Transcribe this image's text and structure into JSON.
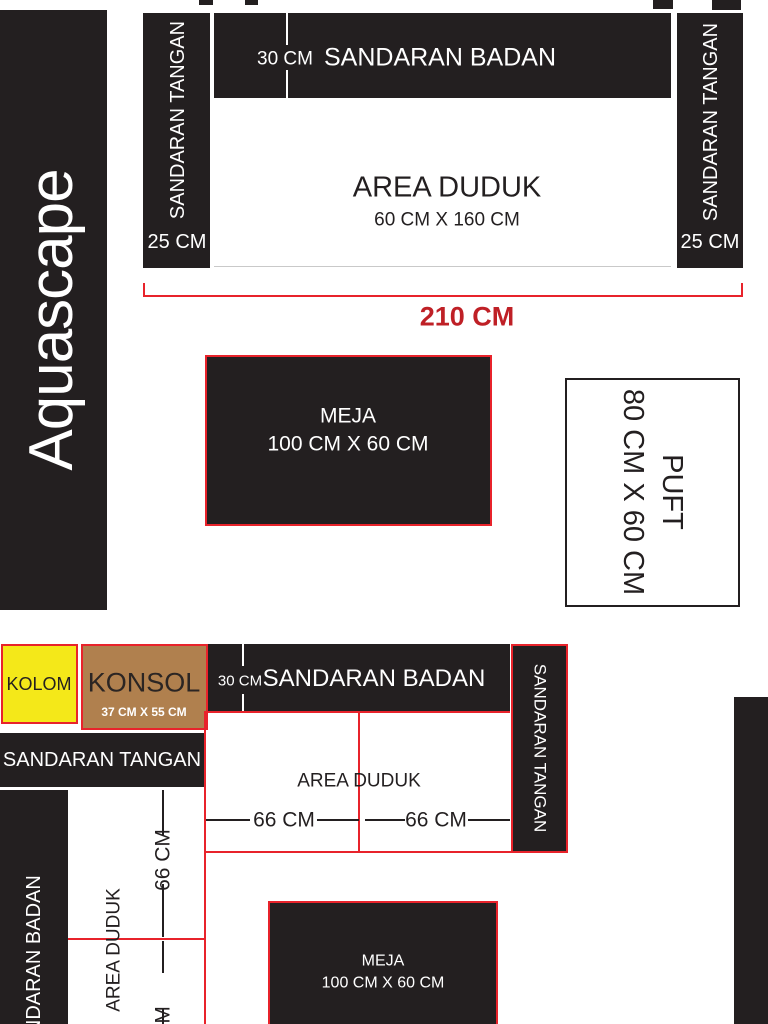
{
  "brand": {
    "name": "Aquascape"
  },
  "colors": {
    "black": "#231f20",
    "red_line": "#e8232b",
    "red_text": "#bf2026",
    "yellow": "#f4e819",
    "brown": "#b0804e"
  },
  "sofa_top": {
    "armrest_left": {
      "label": "SANDARAN TANGAN",
      "size": "25 CM"
    },
    "armrest_right": {
      "label": "SANDARAN TANGAN",
      "size": "25 CM"
    },
    "backrest": {
      "label": "SANDARAN BADAN",
      "depth": "30 CM"
    },
    "seat": {
      "label": "AREA DUDUK",
      "size": "60 CM X 160 CM"
    },
    "overall_width": "210 CM"
  },
  "table_top": {
    "label": "MEJA",
    "size": "100 CM X 60 CM"
  },
  "puft": {
    "label": "PUFT",
    "size": "80 CM X 60 CM"
  },
  "sofa_bottom": {
    "kolom": {
      "label": "KOLOM"
    },
    "konsol": {
      "label": "KONSOL",
      "size": "37 CM X 55 CM"
    },
    "backrest": {
      "label": "SANDARAN BADAN",
      "depth": "30 CM"
    },
    "armrest_right": {
      "label": "SANDARAN TANGAN"
    },
    "armrest_left": {
      "label": "SANDARAN TANGAN"
    },
    "seat": {
      "label": "AREA DUDUK",
      "segment1": "66 CM",
      "segment2": "66 CM"
    },
    "wing": {
      "backrest": "SANDARAN BADAN",
      "seat": "AREA DUDUK",
      "segment1": "66 CM",
      "segment2": "66 CM"
    }
  },
  "table_bottom": {
    "label": "MEJA",
    "size": "100 CM X 60 CM"
  }
}
